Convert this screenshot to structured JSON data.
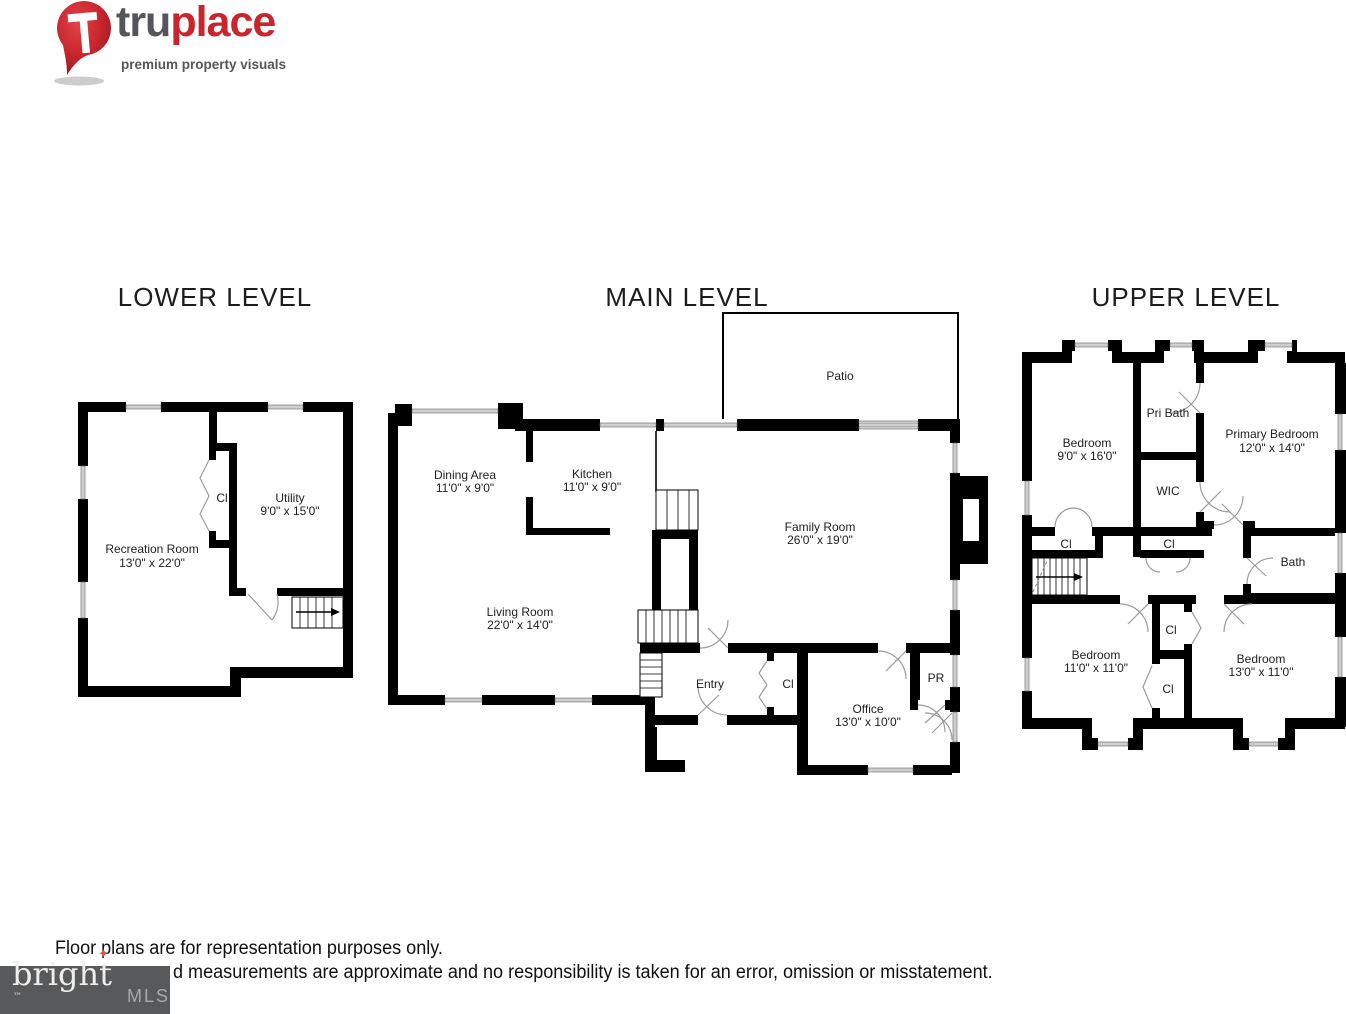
{
  "brand_logo": {
    "name_part1": "tru",
    "name_part2": "place",
    "tagline": "premium property visuals",
    "pin_icon": "map-pin-with-T",
    "colors": {
      "name_part1": "#55565a",
      "name_part2": "#c9252c",
      "pin": "#c9252c"
    }
  },
  "levels": {
    "lower": {
      "title": "LOWER LEVEL",
      "rooms": {
        "recreation": {
          "name": "Recreation Room",
          "dims": "13'0\" x 22'0\""
        },
        "utility": {
          "name": "Utility",
          "dims": "9'0\" x 15'0\""
        },
        "closet": {
          "name": "Cl"
        }
      }
    },
    "main": {
      "title": "MAIN LEVEL",
      "rooms": {
        "patio": {
          "name": "Patio"
        },
        "dining": {
          "name": "Dining Area",
          "dims": "11'0\" x 9'0\""
        },
        "kitchen": {
          "name": "Kitchen",
          "dims": "11'0\" x 9'0\""
        },
        "living": {
          "name": "Living Room",
          "dims": "22'0\" x 14'0\""
        },
        "family": {
          "name": "Family Room",
          "dims": "26'0\" x 19'0\""
        },
        "entry": {
          "name": "Entry"
        },
        "closet": {
          "name": "Cl"
        },
        "office": {
          "name": "Office",
          "dims": "13'0\" x 10'0\""
        },
        "powder_room": {
          "name": "PR"
        }
      }
    },
    "upper": {
      "title": "UPPER LEVEL",
      "rooms": {
        "bedroom_left": {
          "name": "Bedroom",
          "dims": "9'0\" x 16'0\""
        },
        "pri_bath": {
          "name": "Pri Bath"
        },
        "primary_bedroom": {
          "name": "Primary Bedroom",
          "dims": "12'0\" x 14'0\""
        },
        "wic": {
          "name": "WIC"
        },
        "closet_hall_left": {
          "name": "Cl"
        },
        "closet_hall_center": {
          "name": "Cl"
        },
        "bath": {
          "name": "Bath"
        },
        "bedroom_lower_left": {
          "name": "Bedroom",
          "dims": "11'0\" x 11'0\""
        },
        "closet_mid_top": {
          "name": "Cl"
        },
        "closet_mid_bottom": {
          "name": "Cl"
        },
        "bedroom_lower_right": {
          "name": "Bedroom",
          "dims": "13'0\" x 11'0\""
        }
      }
    }
  },
  "footer": {
    "disclaimer_line1": "Floor plans are for representation purposes only.",
    "disclaimer_line2": "d measurements are approximate and no responsibility is taken for an error, omission or misstatement."
  },
  "mls_logo": {
    "brand": "brigh",
    "brand_last_letter": "t",
    "trademark": "™",
    "suffix": "MLS",
    "star_icon": "✦",
    "colors": {
      "background": "#58595b",
      "brand": "#efeeec",
      "suffix": "#a7a9ac",
      "star": "#e8522d"
    }
  }
}
